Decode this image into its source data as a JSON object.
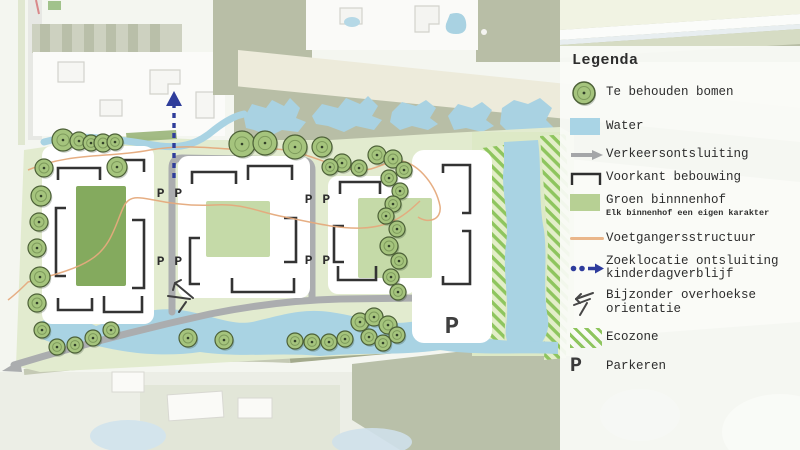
{
  "legend": {
    "title": "Legenda",
    "items": [
      {
        "icon": "tree-icon",
        "label": "Te behouden bomen"
      },
      {
        "icon": "water-swatch",
        "label": "Water"
      },
      {
        "icon": "traffic-arrow-icon",
        "label": "Verkeersontsluiting"
      },
      {
        "icon": "building-front-icon",
        "label": "Voorkant bebouwing"
      },
      {
        "icon": "courtyard-swatch",
        "label": "Groen binnnenhof",
        "sublabel": "Elk binnenhof een eigen karakter"
      },
      {
        "icon": "pedestrian-line-icon",
        "label": "Voetgangersstructuur"
      },
      {
        "icon": "dashed-arrow-icon",
        "label": "Zoeklocatie ontsluiting kinderdagverblijf"
      },
      {
        "icon": "corner-orientation-icon",
        "label": "Bijzonder overhoekse orientatie"
      },
      {
        "icon": "ecozone-swatch",
        "label": "Ecozone"
      },
      {
        "icon": "parking-icon",
        "label": "Parkeren",
        "symbol": "P"
      }
    ]
  },
  "map": {
    "parking_labels": [
      {
        "x": 170,
        "y": 197,
        "text": "P P"
      },
      {
        "x": 170,
        "y": 265,
        "text": "P P"
      },
      {
        "x": 318,
        "y": 203,
        "text": "P P"
      },
      {
        "x": 318,
        "y": 264,
        "text": "P P"
      },
      {
        "x": 452,
        "y": 333,
        "text": "P",
        "large": true
      }
    ],
    "trees": [
      [
        63,
        140,
        11
      ],
      [
        79,
        141,
        9
      ],
      [
        91,
        143,
        8
      ],
      [
        103,
        143,
        9
      ],
      [
        115,
        142,
        8
      ],
      [
        117,
        167,
        10
      ],
      [
        44,
        168,
        9
      ],
      [
        41,
        196,
        10
      ],
      [
        39,
        222,
        9
      ],
      [
        37,
        248,
        9
      ],
      [
        40,
        277,
        10
      ],
      [
        37,
        303,
        9
      ],
      [
        42,
        330,
        8
      ],
      [
        57,
        347,
        8
      ],
      [
        75,
        345,
        8
      ],
      [
        93,
        338,
        8
      ],
      [
        111,
        330,
        8
      ],
      [
        188,
        338,
        9
      ],
      [
        224,
        340,
        9
      ],
      [
        295,
        341,
        8
      ],
      [
        312,
        342,
        8
      ],
      [
        329,
        342,
        8
      ],
      [
        345,
        339,
        8
      ],
      [
        360,
        322,
        9
      ],
      [
        374,
        317,
        9
      ],
      [
        388,
        325,
        9
      ],
      [
        369,
        337,
        8
      ],
      [
        383,
        343,
        8
      ],
      [
        397,
        335,
        8
      ],
      [
        242,
        144,
        13
      ],
      [
        265,
        143,
        12
      ],
      [
        295,
        147,
        12
      ],
      [
        322,
        147,
        10
      ],
      [
        342,
        163,
        9
      ],
      [
        359,
        168,
        8
      ],
      [
        377,
        155,
        9
      ],
      [
        393,
        159,
        9
      ],
      [
        404,
        170,
        8
      ],
      [
        389,
        178,
        8
      ],
      [
        400,
        191,
        8
      ],
      [
        393,
        204,
        8
      ],
      [
        386,
        216,
        8
      ],
      [
        397,
        229,
        8
      ],
      [
        389,
        246,
        9
      ],
      [
        399,
        261,
        8
      ],
      [
        391,
        277,
        8
      ],
      [
        398,
        292,
        8
      ],
      [
        330,
        167,
        8
      ]
    ]
  },
  "colors": {
    "tree_green": "#a5c47d",
    "water_blue": "#a9d4e5",
    "road_gray": "#abadaf",
    "courtyard_dark_green": "#84aa5e",
    "courtyard_light_green": "#c5daa8",
    "pedestrian_orange": "#e5aa7d",
    "daycare_arrow_blue": "#2f3d9b",
    "ecozone_green": "#8ec55e",
    "site_green": "#e2ebcf",
    "background_sage": "#b8bea6",
    "text_dark": "#2d2d2d"
  }
}
